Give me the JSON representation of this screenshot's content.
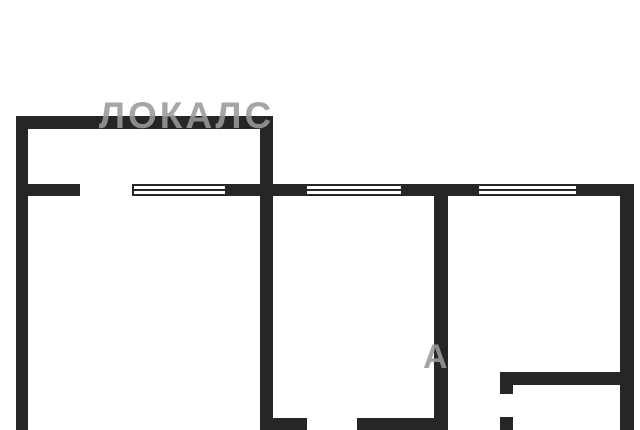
{
  "plan": {
    "background": "#ffffff",
    "wall_color": "#262626",
    "window_fill": "#ffffff",
    "walls": [
      {
        "name": "top-wall",
        "x": 16,
        "y": 116,
        "w": 257,
        "h": 13
      },
      {
        "name": "left-wall",
        "x": 16,
        "y": 116,
        "w": 12,
        "h": 314
      },
      {
        "name": "center-wall",
        "x": 260,
        "y": 116,
        "w": 13,
        "h": 314
      },
      {
        "name": "window-sill-stub-left",
        "x": 28,
        "y": 184,
        "w": 52,
        "h": 12
      },
      {
        "name": "window-pier-1",
        "x": 227,
        "y": 184,
        "w": 78,
        "h": 12
      },
      {
        "name": "window-pier-2",
        "x": 403,
        "y": 184,
        "w": 74,
        "h": 12
      },
      {
        "name": "window-pier-3",
        "x": 578,
        "y": 184,
        "w": 56,
        "h": 12
      },
      {
        "name": "middle-room-divider-wall",
        "x": 434,
        "y": 196,
        "w": 14,
        "h": 234
      },
      {
        "name": "right-wall",
        "x": 620,
        "y": 196,
        "w": 14,
        "h": 234
      },
      {
        "name": "bottom-wall-left-of-door",
        "x": 260,
        "y": 418,
        "w": 47,
        "h": 12
      },
      {
        "name": "bottom-wall-right-of-door",
        "x": 357,
        "y": 418,
        "w": 77,
        "h": 12
      },
      {
        "name": "hall-wall-horizontal",
        "x": 500,
        "y": 372,
        "w": 134,
        "h": 13
      },
      {
        "name": "hall-door-jamb-top",
        "x": 500,
        "y": 372,
        "w": 13,
        "h": 22
      },
      {
        "name": "hall-door-jamb-bottom",
        "x": 500,
        "y": 417,
        "w": 13,
        "h": 13
      }
    ],
    "windows": [
      {
        "name": "window-1",
        "x": 132,
        "y": 184,
        "w": 95,
        "h": 12
      },
      {
        "name": "window-2",
        "x": 305,
        "y": 184,
        "w": 98,
        "h": 12
      },
      {
        "name": "window-3",
        "x": 477,
        "y": 184,
        "w": 101,
        "h": 12
      }
    ]
  },
  "watermarks": {
    "main": {
      "text": "ЛОКАЛС",
      "color": "#9a9a9a"
    },
    "fragment": {
      "text": "А",
      "color": "#9a9a9a"
    }
  }
}
